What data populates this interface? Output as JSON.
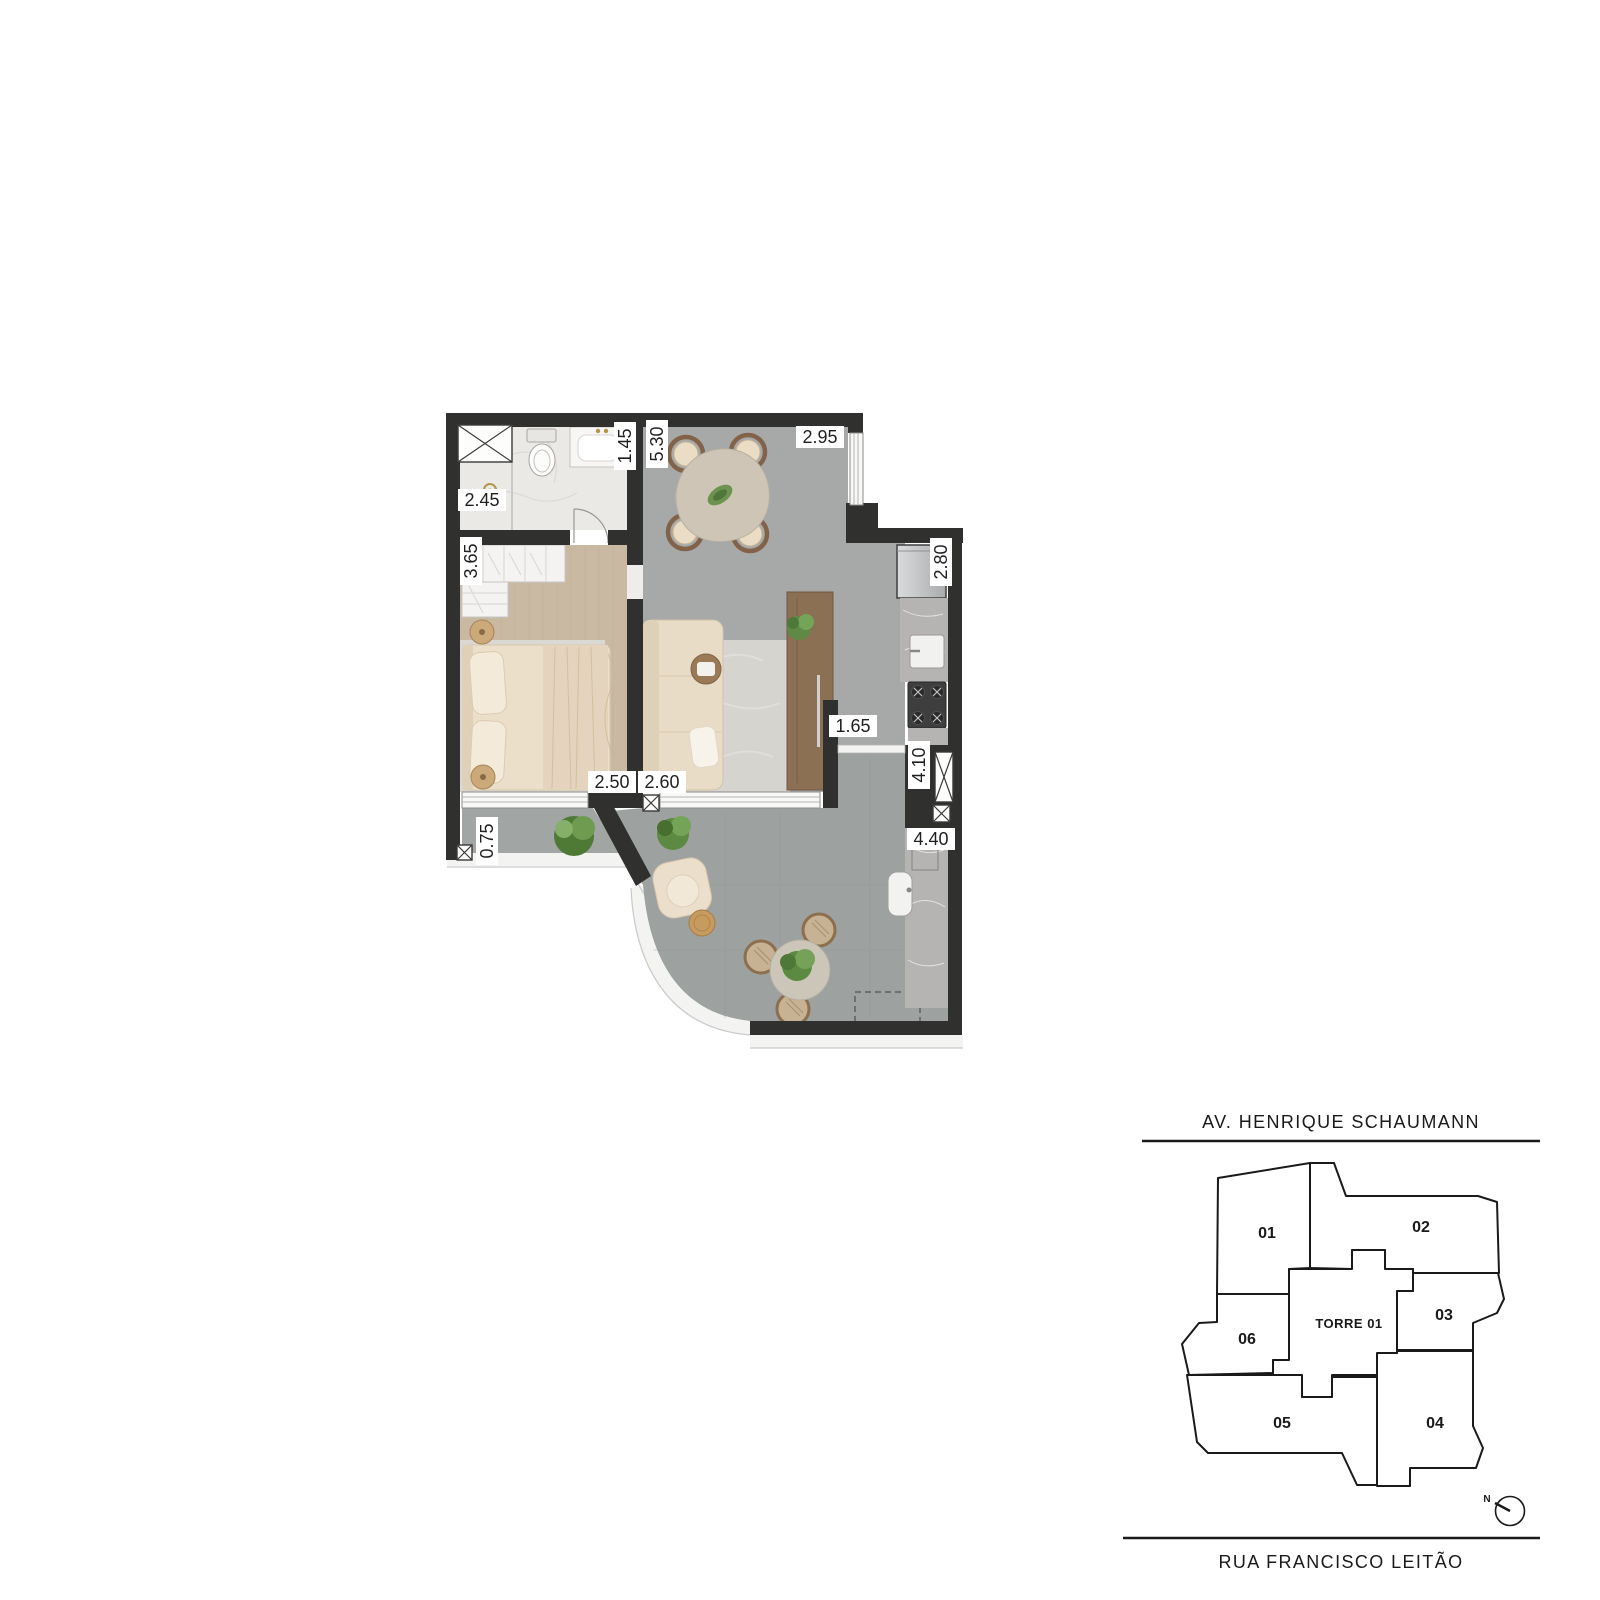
{
  "floor_plan": {
    "dimensions": [
      {
        "value": "2.45",
        "orientation": "horizontal",
        "area": "bathroom"
      },
      {
        "value": "1.45",
        "orientation": "vertical",
        "area": "bathroom-vanity"
      },
      {
        "value": "5.30",
        "orientation": "vertical",
        "area": "living-dining"
      },
      {
        "value": "2.95",
        "orientation": "horizontal",
        "area": "dining"
      },
      {
        "value": "3.65",
        "orientation": "vertical",
        "area": "bedroom"
      },
      {
        "value": "2.80",
        "orientation": "vertical",
        "area": "kitchen"
      },
      {
        "value": "2.50",
        "orientation": "horizontal",
        "area": "bedroom"
      },
      {
        "value": "2.60",
        "orientation": "horizontal",
        "area": "living"
      },
      {
        "value": "1.65",
        "orientation": "horizontal",
        "area": "passage"
      },
      {
        "value": "4.10",
        "orientation": "vertical",
        "area": "service-corridor"
      },
      {
        "value": "4.40",
        "orientation": "horizontal",
        "area": "terrace-counter"
      },
      {
        "value": "0.75",
        "orientation": "vertical",
        "area": "balcony"
      }
    ],
    "colors": {
      "wall": "#30302e",
      "living_floor": "#a7a9a8",
      "terrace_floor": "#9da1a0",
      "balcony_floor": "#a1a5a4",
      "bedroom_floor": "#c9b9a3",
      "bathroom_floor": "#ebe9e6",
      "counter_marble": "#b6b4b3",
      "wood_furniture": "#8c7053",
      "accent_gold": "#b3954e"
    }
  },
  "key_plan": {
    "street_top": "AV. HENRIQUE SCHAUMANN",
    "street_bottom": "RUA FRANCISCO LEITÃO",
    "tower_label": "TORRE 01",
    "compass_label": "N",
    "highlight_color": "#ac8c60",
    "tower_fill": "#cdcdcf",
    "units": [
      {
        "number": "01",
        "highlighted": false
      },
      {
        "number": "02",
        "highlighted": false
      },
      {
        "number": "03",
        "highlighted": true
      },
      {
        "number": "04",
        "highlighted": false
      },
      {
        "number": "05",
        "highlighted": false
      },
      {
        "number": "06",
        "highlighted": true
      }
    ]
  }
}
